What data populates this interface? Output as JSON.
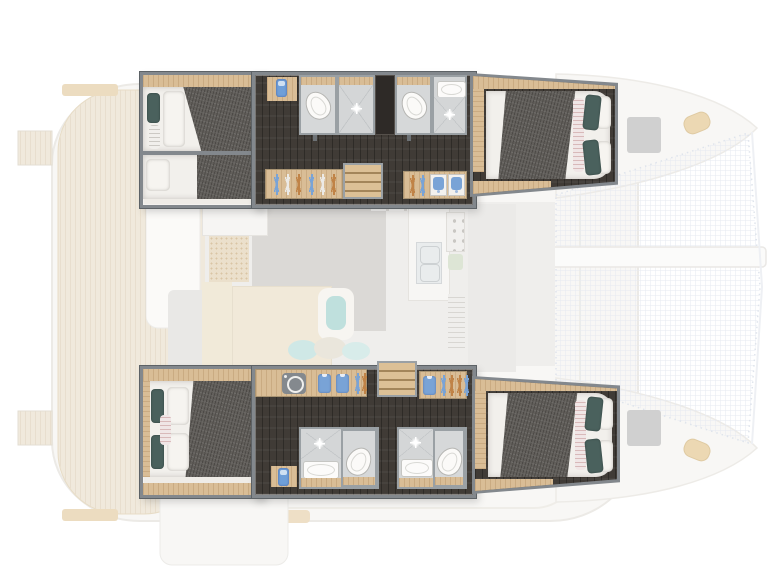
{
  "view": {
    "description": "Top-down interior layout plan of a four-cabin sailing catamaran; saturated hull accommodation plan drawn over a faded main-deck plan",
    "orientation": {
      "bow": "right",
      "stern": "left"
    },
    "hull_count": 2,
    "cabin_count": 4,
    "bathroom_count": 4
  },
  "palette": {
    "wall": "#83888d",
    "wall_dark": "#5d6266",
    "floor_dark": "#403b36",
    "oak": "#d9bd96",
    "duvet": "#625f5b",
    "linen": "#f2f0ec",
    "teal": "#4a615d",
    "bath_floor": "#d6d8d9",
    "blue": "#79a3d6",
    "orange": "#c08347",
    "pink_stripe": "#d8b9b9",
    "teak": "#efe7d9",
    "net_line": "#e4e9f0",
    "hatch_gray": "#d0d0d0",
    "rug_gray": "#dbd9d6"
  },
  "port_hull": {
    "position": "top",
    "aft_cabin": {
      "beds": 2,
      "duvet": "dark gray",
      "pillows": [
        "teal",
        "white",
        "striped bolster"
      ]
    },
    "aft_head": {
      "fixtures": [
        "toilet",
        "shower"
      ]
    },
    "forward_head": {
      "fixtures": [
        "toilet",
        "washbasin",
        "shower"
      ]
    },
    "forward_cabin": {
      "beds": 1,
      "duvet": "dark gray",
      "pillows": [
        "teal",
        "white",
        "striped runner"
      ]
    },
    "wardrobe_aft": {
      "hangers": 6,
      "hanger_colors": [
        "blue",
        "white",
        "orange",
        "blue",
        "white",
        "orange"
      ]
    },
    "wardrobe_forward": {
      "hangers": 2,
      "hanger_colors": [
        "orange",
        "blue"
      ],
      "towel_cubbies": 3,
      "towel_color": "blue"
    },
    "companionway_steps": 4
  },
  "starboard_hull": {
    "position": "bottom",
    "aft_cabin": {
      "beds": 1,
      "duvet": "dark gray",
      "pillows": [
        "teal",
        "white",
        "striped bolster"
      ]
    },
    "aft_head": {
      "fixtures": [
        "shower",
        "washbasin",
        "toilet"
      ]
    },
    "forward_head": {
      "fixtures": [
        "shower",
        "washbasin",
        "toilet"
      ]
    },
    "forward_cabin": {
      "beds": 1,
      "duvet": "dark gray",
      "pillows": [
        "teal",
        "white",
        "striped runner"
      ]
    },
    "wardrobe_aft": {
      "washing_machine": true,
      "folded_shirts": 2,
      "hangers": 3,
      "hanger_colors": [
        "blue",
        "orange",
        "blue"
      ]
    },
    "wardrobe_forward": {
      "folded_shirts": 1,
      "hangers": 4,
      "hanger_colors": [
        "blue",
        "orange",
        "orange",
        "blue"
      ]
    },
    "companionway_steps": 4
  },
  "deck_faded": {
    "features": [
      "stern swim platforms",
      "teak cockpit deck",
      "cockpit furniture",
      "saloon rug",
      "saloon daybed with cushions",
      "peg-board panel",
      "galley island with double sink",
      "stove with burners",
      "tall fridge panel",
      "foredeck hatches",
      "bow cleats",
      "trampoline nets",
      "forward crossbeam"
    ]
  }
}
